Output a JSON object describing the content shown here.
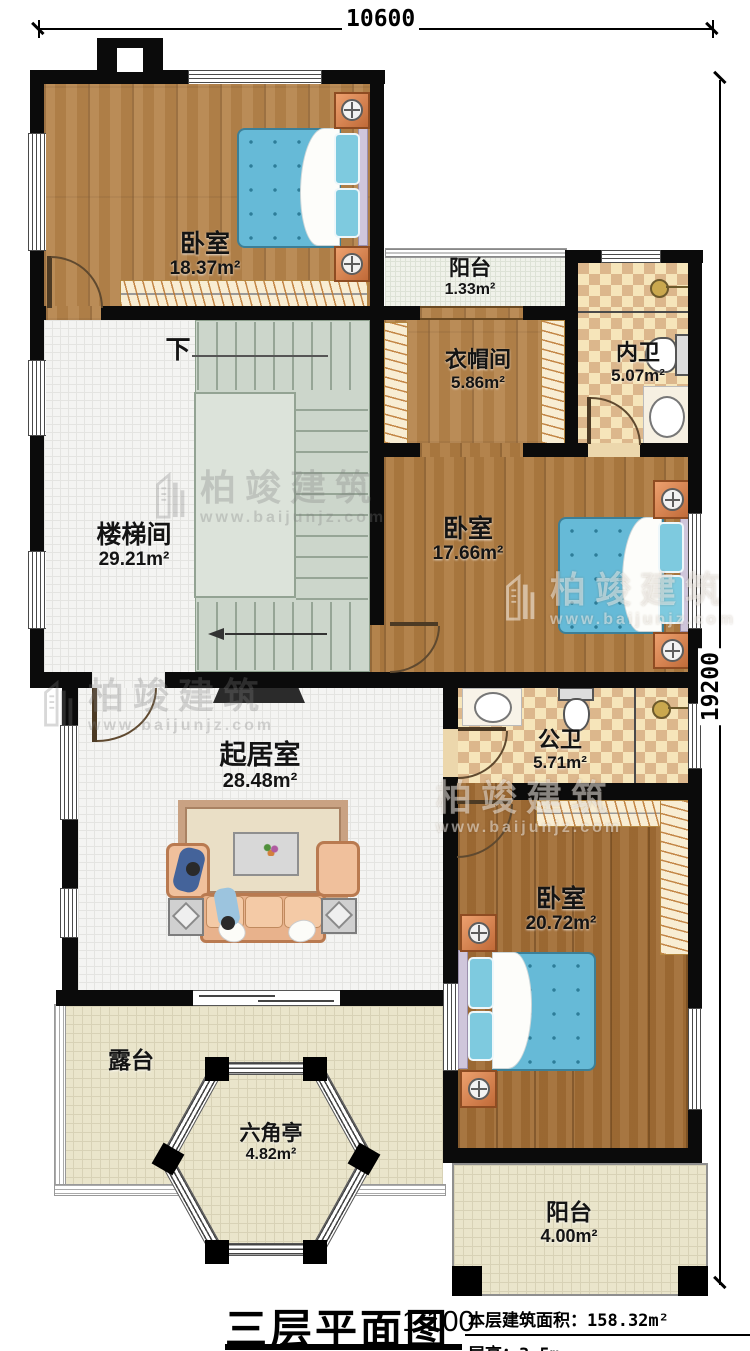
{
  "dimensions": {
    "width": "10600",
    "height": "19200"
  },
  "stair": {
    "down_label": "下"
  },
  "rooms": [
    {
      "id": "bedroom-top",
      "name": "卧室",
      "area": "18.37m²"
    },
    {
      "id": "balcony-top",
      "name": "阳台",
      "area": "1.33m²"
    },
    {
      "id": "cloakroom",
      "name": "衣帽间",
      "area": "5.86m²"
    },
    {
      "id": "ensuite-bath",
      "name": "内卫",
      "area": "5.07m²"
    },
    {
      "id": "stairwell",
      "name": "楼梯间",
      "area": "29.21m²"
    },
    {
      "id": "bedroom-middle",
      "name": "卧室",
      "area": "17.66m²"
    },
    {
      "id": "public-bath",
      "name": "公卫",
      "area": "5.71m²"
    },
    {
      "id": "living-room",
      "name": "起居室",
      "area": "28.48m²"
    },
    {
      "id": "bedroom-bottom",
      "name": "卧室",
      "area": "20.72m²"
    },
    {
      "id": "terrace",
      "name": "露台",
      "area": ""
    },
    {
      "id": "pavilion",
      "name": "六角亭",
      "area": "4.82m²"
    },
    {
      "id": "balcony-bottom",
      "name": "阳台",
      "area": "4.00m²"
    }
  ],
  "title": {
    "name": "三层平面图",
    "scale": "1:100",
    "area_label": "本层建筑面积：",
    "area_value": "158.32m²",
    "floor_height_label": "层高：",
    "floor_height_value": "3.5m"
  },
  "watermark": {
    "name": "柏竣建筑",
    "url": "www.baijunjz.com"
  },
  "colors": {
    "wall": "#0b0b0b",
    "wood": "#b5834a",
    "bath_tile": "#dcb78c",
    "bed": "#66bad7",
    "terrace": "#eae5cb"
  }
}
